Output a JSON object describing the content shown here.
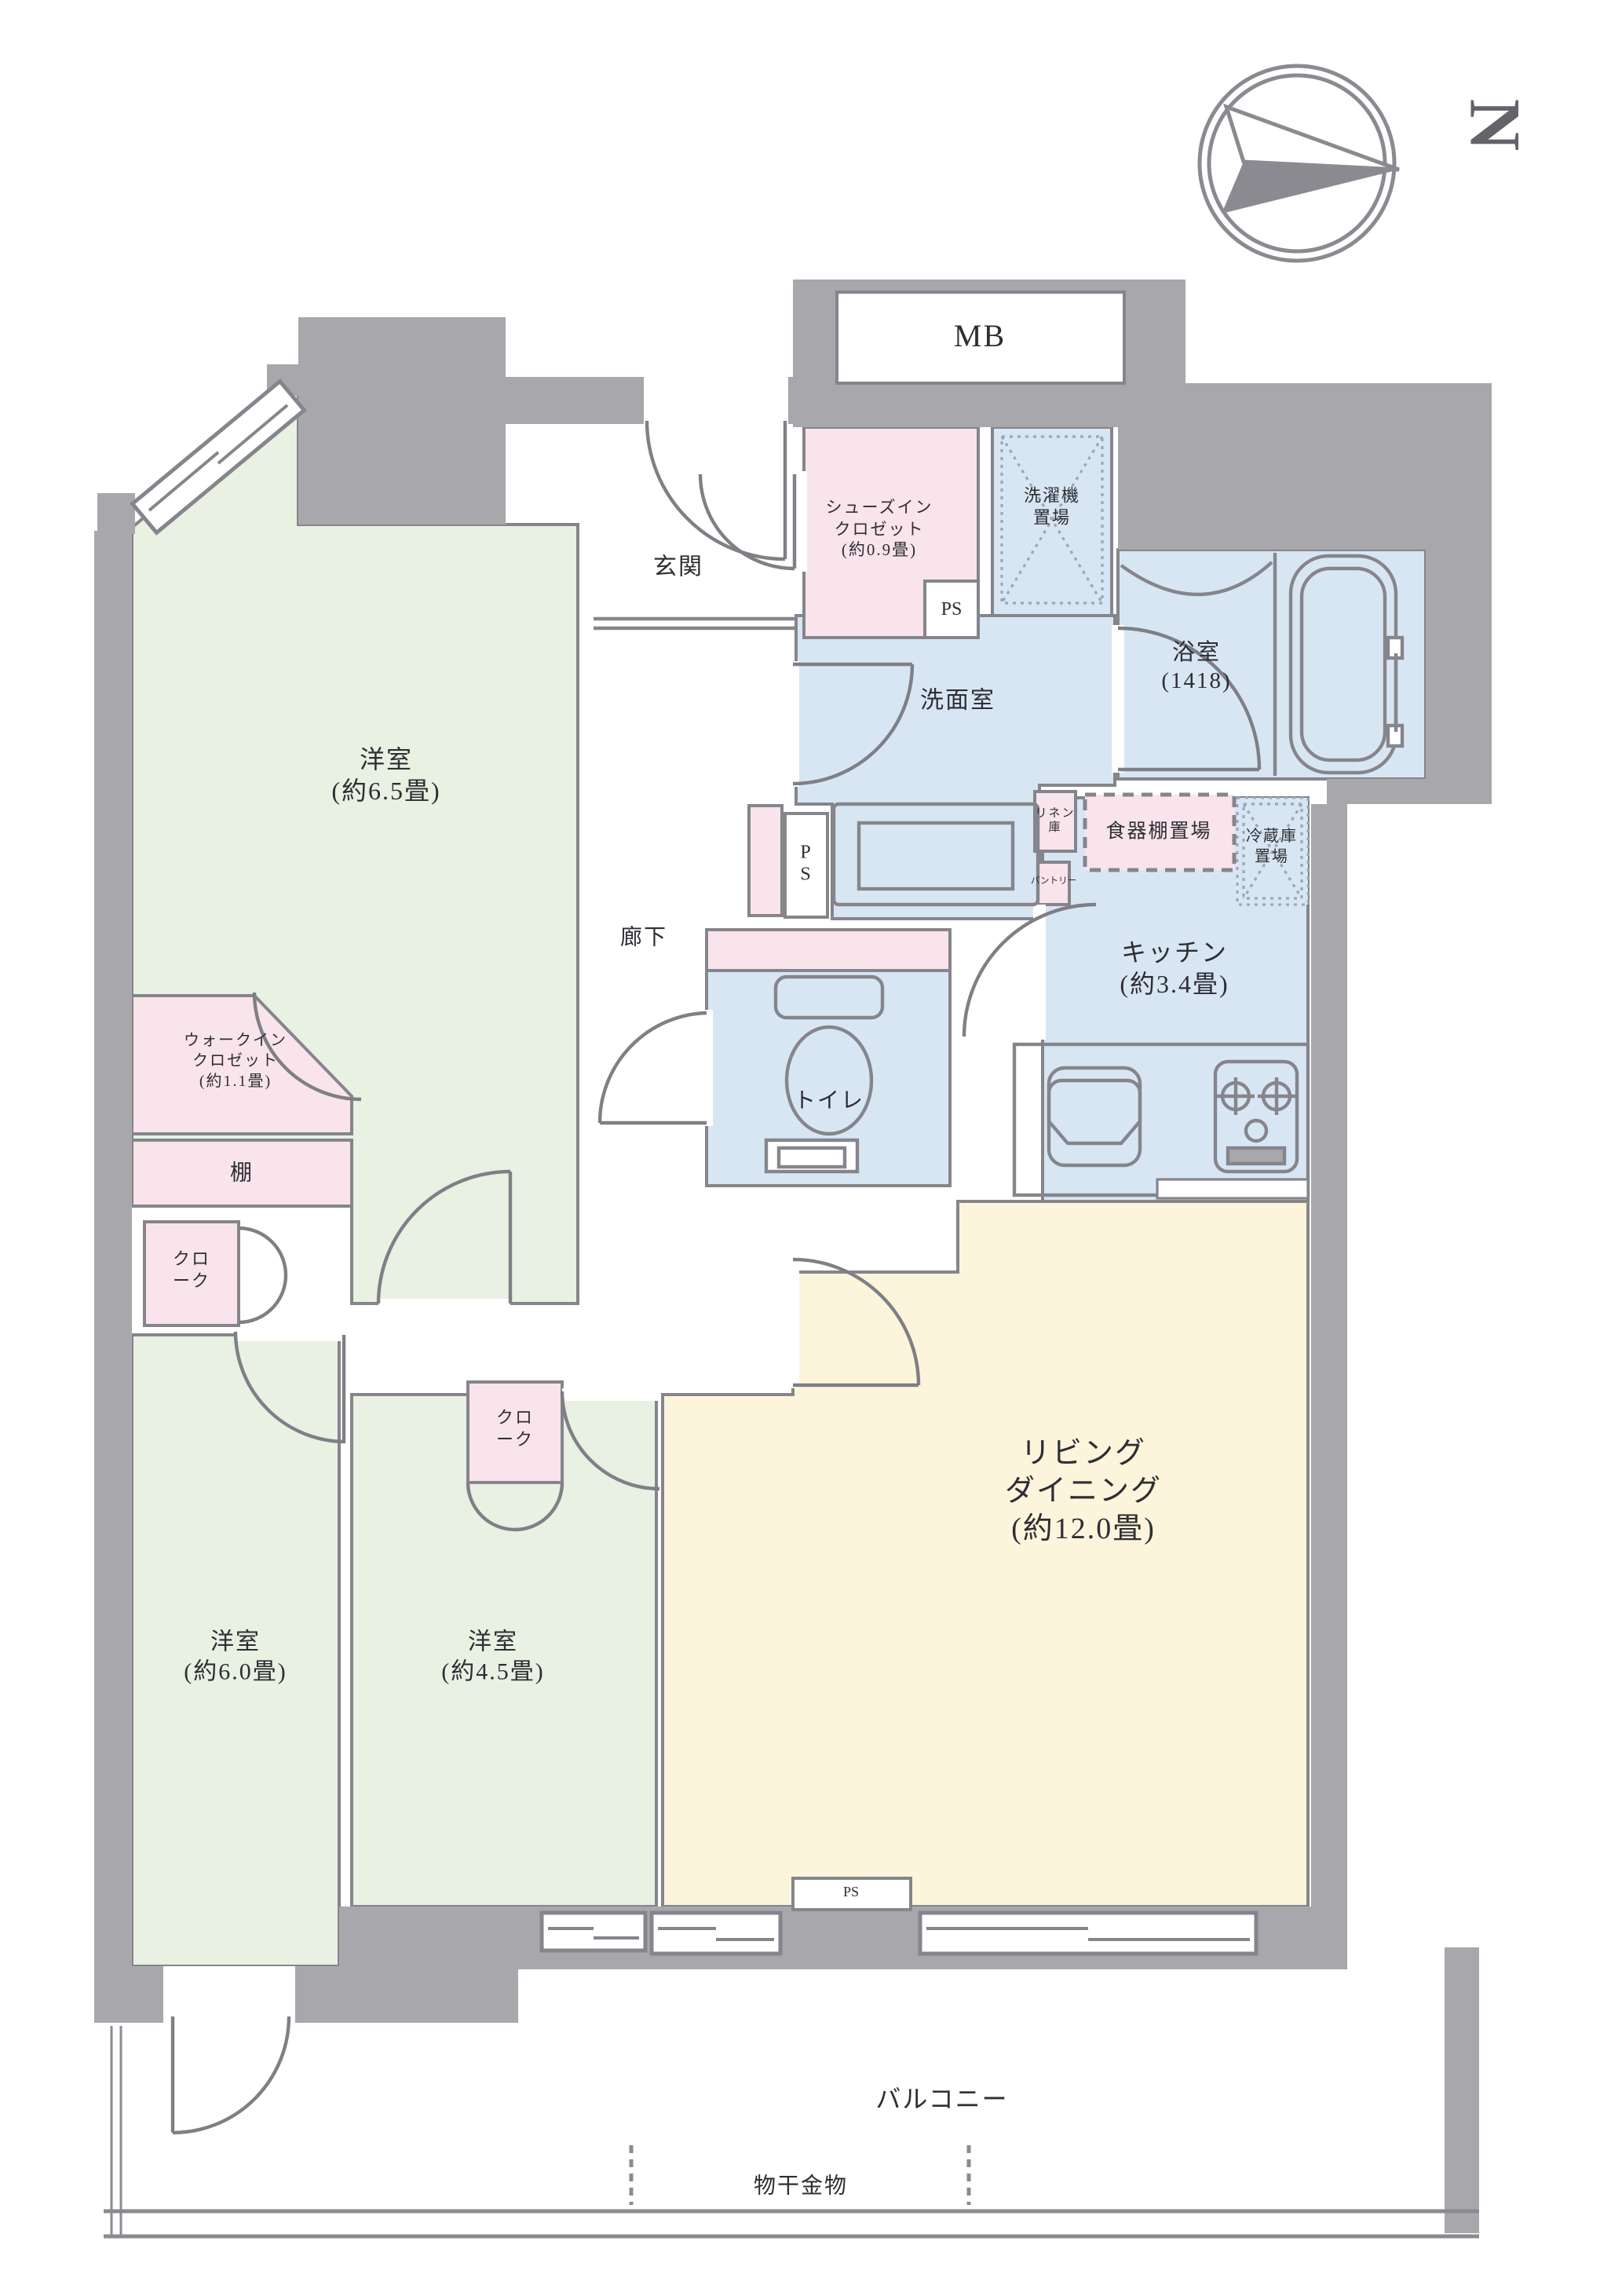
{
  "title": "間取り図",
  "compass": {
    "north": "N"
  },
  "labels": {
    "mb": "MB",
    "genkan": "玄関",
    "shoes_closet": "シューズイン\nクロゼット\n(約0.9畳)",
    "ps_shoes": "PS",
    "washer": "洗濯機\n置場",
    "senmen": "洗面室",
    "bath": "浴室\n(1418)",
    "linen": "リネン\n庫",
    "pantry": "パントリー",
    "dish_shelf": "食器棚置場",
    "fridge": "冷蔵庫\n置場",
    "kitchen": "キッチン\n(約3.4畳)",
    "rouka": "廊下",
    "toilet": "トイレ",
    "ps_corridor": "P\nS",
    "wic": "ウォークイン\nクロゼット\n(約1.1畳)",
    "tana": "棚",
    "cloak_left": "クロ\nーク",
    "cloak_mid": "クロ\nーク",
    "room65": "洋室\n(約6.5畳)",
    "room60": "洋室\n(約6.0畳)",
    "room45": "洋室\n(約4.5畳)",
    "living_dining": "リビング\nダイニング\n(約12.0畳)",
    "balcony": "バルコニー",
    "monohoshi": "物干金物",
    "ps_bottom": "PS"
  },
  "rooms": [
    {
      "name": "洋室",
      "area": "約6.5畳"
    },
    {
      "name": "洋室",
      "area": "約6.0畳"
    },
    {
      "name": "洋室",
      "area": "約4.5畳"
    },
    {
      "name": "リビングダイニング",
      "area": "約12.0畳"
    },
    {
      "name": "キッチン",
      "area": "約3.4畳"
    },
    {
      "name": "浴室",
      "area": "1418"
    },
    {
      "name": "洗面室",
      "area": ""
    },
    {
      "name": "トイレ",
      "area": ""
    },
    {
      "name": "玄関",
      "area": ""
    },
    {
      "name": "廊下",
      "area": ""
    },
    {
      "name": "シューズインクロゼット",
      "area": "約0.9畳"
    },
    {
      "name": "ウォークインクロゼット",
      "area": "約1.1畳"
    },
    {
      "name": "バルコニー",
      "area": ""
    }
  ],
  "colors": {
    "room_green": "#e8f1e2",
    "closet_pink": "#f9e4ec",
    "wet_blue": "#d8e6f4",
    "living_cream": "#fcf5dc",
    "wall_gray": "#a7a7ac",
    "line_gray": "#85858b"
  }
}
